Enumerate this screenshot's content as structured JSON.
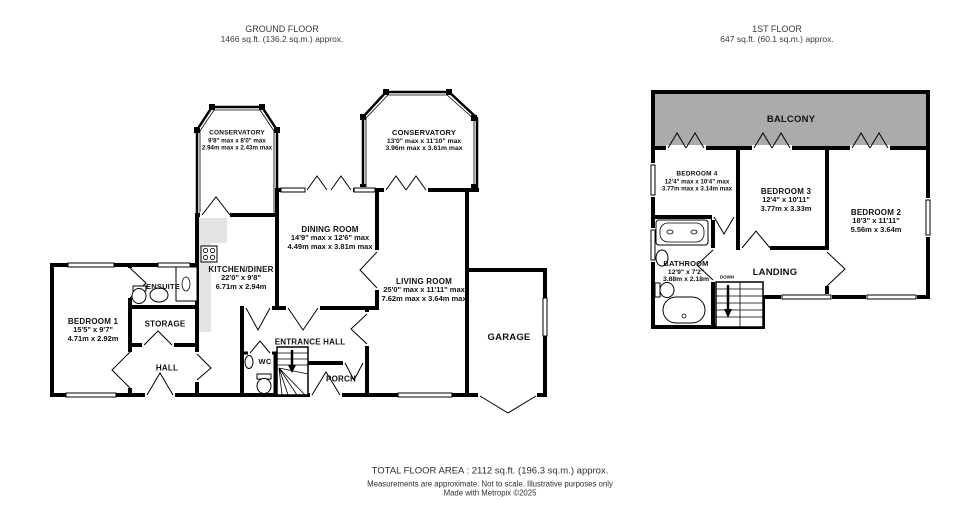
{
  "ground_floor": {
    "title": "GROUND FLOOR",
    "subtitle": "1466 sq.ft. (136.2 sq.m.) approx.",
    "rooms": {
      "conservatory_small": {
        "name": "CONSERVATORY",
        "ft": "9'8\" max x 8'0\" max",
        "m": "2.94m max x 2.43m max"
      },
      "conservatory_large": {
        "name": "CONSERVATORY",
        "ft": "13'0\" max x 11'10\" max",
        "m": "3.96m max x 3.61m max"
      },
      "dining": {
        "name": "DINING ROOM",
        "ft": "14'9\" max x 12'6\" max",
        "m": "4.49m max x 3.81m max"
      },
      "kitchen": {
        "name": "KITCHEN/DINER",
        "ft": "22'0\"  x 9'8\"",
        "m": "6.71m  x 2.94m"
      },
      "living": {
        "name": "LIVING ROOM",
        "ft": "25'0\" max x 11'11\" max",
        "m": "7.62m max x 3.64m max"
      },
      "bedroom1": {
        "name": "BEDROOM 1",
        "ft": "15'5\"  x 9'7\"",
        "m": "4.71m  x 2.92m"
      },
      "ensuite": {
        "name": "ENSUITE"
      },
      "storage": {
        "name": "STORAGE"
      },
      "hall": {
        "name": "HALL"
      },
      "entrance_hall": {
        "name": "ENTRANCE HALL"
      },
      "wc": {
        "name": "WC"
      },
      "porch": {
        "name": "PORCH"
      },
      "garage": {
        "name": "GARAGE"
      }
    }
  },
  "first_floor": {
    "title": "1ST FLOOR",
    "subtitle": "647 sq.ft. (60.1 sq.m.) approx.",
    "rooms": {
      "balcony": {
        "name": "BALCONY"
      },
      "bedroom4": {
        "name": "BEDROOM 4",
        "ft": "12'4\" max x 10'4\" max",
        "m": "3.77m max x 3.14m max"
      },
      "bedroom3": {
        "name": "BEDROOM 3",
        "ft": "12'4\"  x 10'11\"",
        "m": "3.77m  x 3.33m"
      },
      "bedroom2": {
        "name": "BEDROOM 2",
        "ft": "18'3\"  x 11'11\"",
        "m": "5.56m  x 3.64m"
      },
      "bathroom": {
        "name": "BATHROOM",
        "ft": "12'9\"  x 7'2\"",
        "m": "3.88m  x 2.18m"
      },
      "landing": {
        "name": "LANDING"
      },
      "stairs_label": "DOWN"
    }
  },
  "footer": {
    "line1": "TOTAL FLOOR AREA : 2112 sq.ft. (196.3 sq.m.) approx.",
    "line2": "Measurements are approximate.  Not to scale.  Illustrative purposes only",
    "line3": "Made with Metropix ©2025"
  },
  "colors": {
    "wall": "#000000",
    "balcony_fill": "#ababab",
    "counter_fill": "#e4e4e4",
    "background": "#ffffff"
  }
}
